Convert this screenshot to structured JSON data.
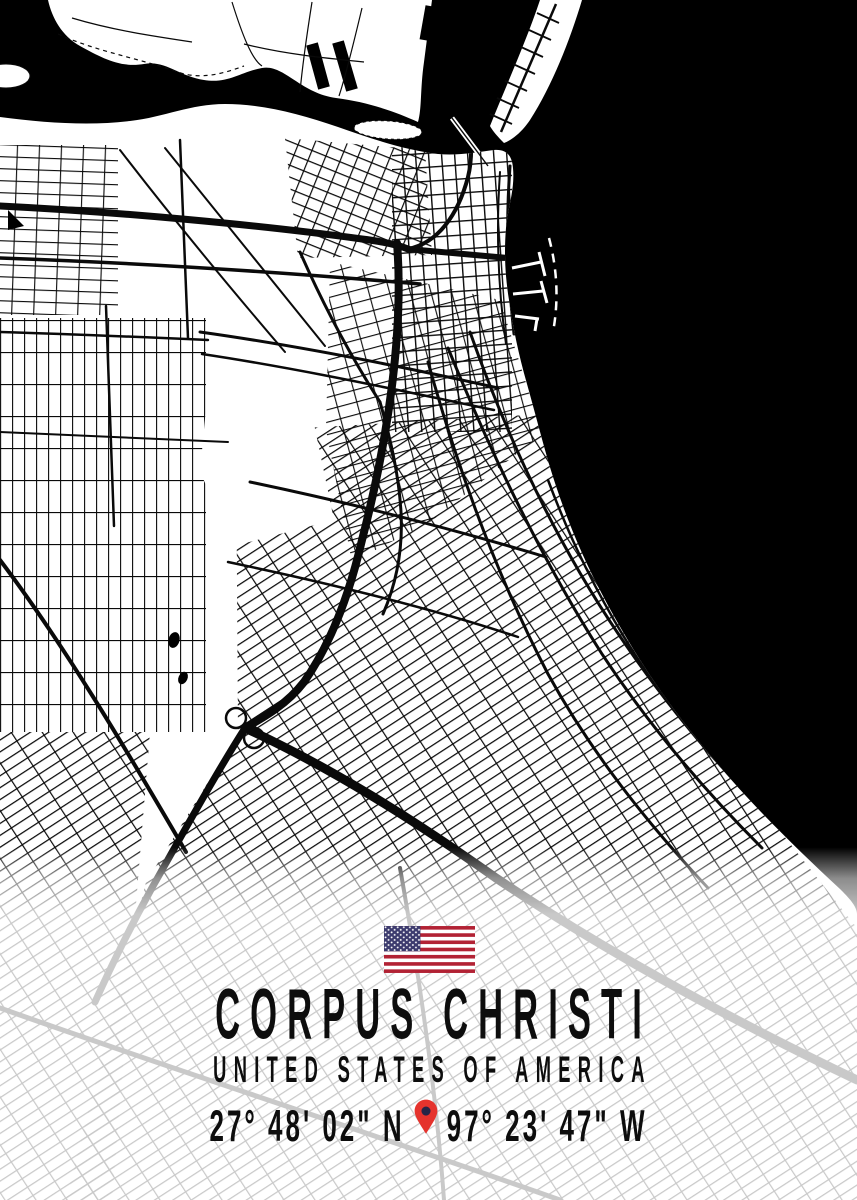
{
  "poster": {
    "title": "CORPUS CHRISTI",
    "subtitle": "UNITED STATES OF AMERICA",
    "latitude": "27° 48' 02\" N",
    "longitude": "97° 23' 47\" W"
  },
  "map": {
    "city": "Corpus Christi",
    "style": "black and white street map, bay water solid black, bottom faded white band for caption",
    "water_color": "#000000",
    "land_color": "#ffffff",
    "street_color": "#0a0a0a",
    "faded_street_color": "#c6c6c6"
  },
  "icons": {
    "flag": "us-flag-icon",
    "pin": "location-pin-icon",
    "pin_color": "#e5332d",
    "pin_dot_color": "#252547",
    "flag_red": "#b22234",
    "flag_blue": "#3c3b6e",
    "flag_white": "#ffffff"
  }
}
